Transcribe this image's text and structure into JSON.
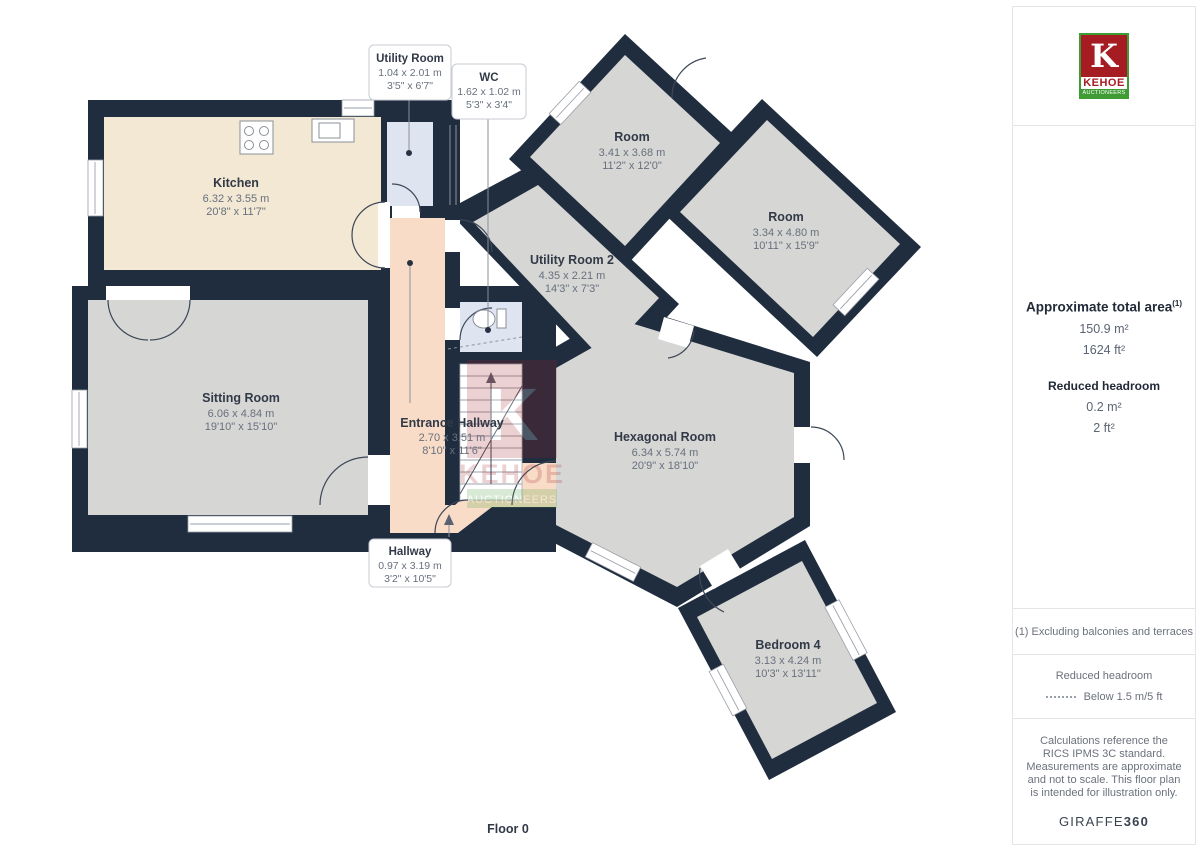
{
  "floor": {
    "label": "Floor 0"
  },
  "rooms": [
    {
      "name": "Kitchen",
      "metric": "6.32 x 3.55 m",
      "imperial": "20'8\" x 11'7\""
    },
    {
      "name": "Sitting Room",
      "metric": "6.06 x 4.84 m",
      "imperial": "19'10\" x 15'10\""
    },
    {
      "name": "Entrance Hallway",
      "metric": "2.70 x 3.51 m",
      "imperial": "8'10\" x 11'6\""
    },
    {
      "name": "Utility Room 2",
      "metric": "4.35 x 2.21 m",
      "imperial": "14'3\" x 7'3\""
    },
    {
      "name": "Room",
      "metric": "3.41 x 3.68 m",
      "imperial": "11'2\" x 12'0\""
    },
    {
      "name": "Room",
      "metric": "3.34 x 4.80 m",
      "imperial": "10'11\" x 15'9\""
    },
    {
      "name": "Hexagonal Room",
      "metric": "6.34 x 5.74 m",
      "imperial": "20'9\" x 18'10\""
    },
    {
      "name": "Bedroom 4",
      "metric": "3.13 x 4.24 m",
      "imperial": "10'3\" x 13'11\""
    }
  ],
  "callouts": [
    {
      "name": "Utility Room",
      "metric": "1.04 x 2.01 m",
      "imperial": "3'5\" x 6'7\""
    },
    {
      "name": "WC",
      "metric": "1.62 x 1.02 m",
      "imperial": "5'3\" x 3'4\""
    },
    {
      "name": "Hallway",
      "metric": "0.97 x 3.19 m",
      "imperial": "3'2\" x 10'5\""
    }
  ],
  "watermark": {
    "k": "K",
    "name": "KEHOE",
    "subtitle": "AUCTIONEERS"
  },
  "sidebar": {
    "logo": {
      "k": "K",
      "name": "KEHOE",
      "subtitle": "AUCTIONEERS"
    },
    "area": {
      "title": "Approximate total area",
      "footnote_ref": "(1)",
      "metric": "150.9 m²",
      "imperial": "1624 ft²"
    },
    "headroom": {
      "title": "Reduced headroom",
      "metric": "0.2 m²",
      "imperial": "2 ft²"
    },
    "footnote": "(1) Excluding balconies and terraces",
    "legend": {
      "title": "Reduced headroom",
      "item": "Below 1.5 m/5 ft"
    },
    "disclaimer": "Calculations reference the RICS IPMS 3C standard. Measurements are approximate and not to scale. This floor plan is intended for illustration only.",
    "brand": {
      "name": "GIRAFFE",
      "suffix": "360"
    }
  },
  "colors": {
    "wall": "#1f2d3e",
    "room_gray": "#d6d6d4",
    "kitchen_cream": "#f2e8d3",
    "hallway_peach": "#f8dcc7",
    "wet_room_blue": "#dfe4f1",
    "logo_red": "#a51d22",
    "logo_green": "#3f9c35"
  }
}
